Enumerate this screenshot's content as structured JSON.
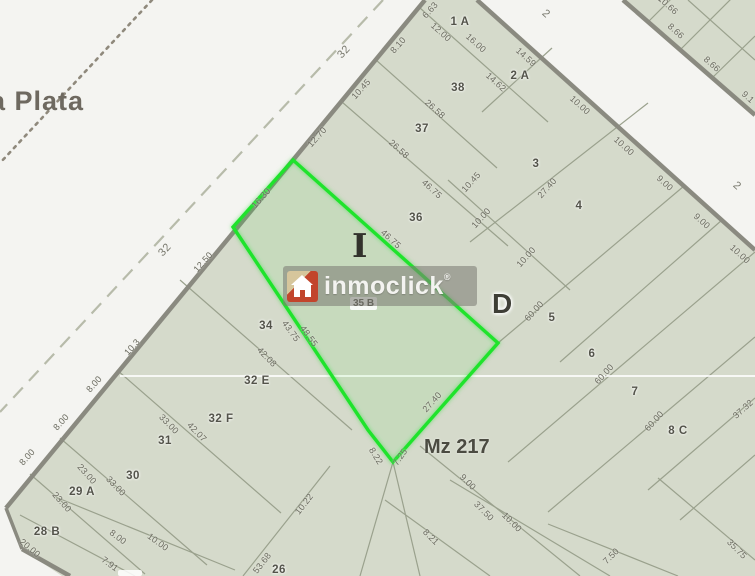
{
  "map": {
    "region_label": "a Plata",
    "block_label": "Mz 217",
    "area_letter_primary": "I",
    "area_letter_secondary": "D",
    "highlight_parcel_id": "35 B",
    "watermark": {
      "brand": "inmoclick",
      "registered_mark": "®",
      "icon": "house-icon"
    },
    "colors": {
      "highlight_green": "#1fe32c",
      "parcel_fill": "#d5dacb",
      "street_fill": "#f4f4f1",
      "street_edge": "#8a8a80",
      "lot_line": "#9aa18d",
      "watermark_red": "#c2452c",
      "watermark_tan": "#d6c69c"
    },
    "street_number_labels": [
      {
        "t": "32",
        "x": 344,
        "y": 52,
        "r": -48
      },
      {
        "t": "32",
        "x": 165,
        "y": 250,
        "r": -48
      },
      {
        "t": "2",
        "x": 546,
        "y": 14,
        "r": 42
      },
      {
        "t": "2",
        "x": 737,
        "y": 186,
        "r": 42
      }
    ],
    "parcel_labels": [
      {
        "t": "1 A",
        "x": 460,
        "y": 22
      },
      {
        "t": "2 A",
        "x": 520,
        "y": 76
      },
      {
        "t": "38",
        "x": 458,
        "y": 88
      },
      {
        "t": "37",
        "x": 422,
        "y": 129
      },
      {
        "t": "36",
        "x": 416,
        "y": 218
      },
      {
        "t": "3",
        "x": 536,
        "y": 164
      },
      {
        "t": "4",
        "x": 579,
        "y": 206
      },
      {
        "t": "5",
        "x": 552,
        "y": 318
      },
      {
        "t": "6",
        "x": 592,
        "y": 354
      },
      {
        "t": "7",
        "x": 635,
        "y": 392
      },
      {
        "t": "8 C",
        "x": 678,
        "y": 431
      },
      {
        "t": "34",
        "x": 266,
        "y": 326
      },
      {
        "t": "32 E",
        "x": 257,
        "y": 381
      },
      {
        "t": "32 F",
        "x": 221,
        "y": 419
      },
      {
        "t": "31",
        "x": 165,
        "y": 441
      },
      {
        "t": "30",
        "x": 133,
        "y": 476
      },
      {
        "t": "29 A",
        "x": 82,
        "y": 492
      },
      {
        "t": "28 B",
        "x": 47,
        "y": 532
      },
      {
        "t": "26",
        "x": 279,
        "y": 570
      }
    ],
    "measurement_labels": [
      {
        "t": "6.63",
        "x": 430,
        "y": 10,
        "r": -48
      },
      {
        "t": "8.10",
        "x": 398,
        "y": 45,
        "r": -48
      },
      {
        "t": "10.45",
        "x": 361,
        "y": 89,
        "r": -48
      },
      {
        "t": "12.70",
        "x": 317,
        "y": 137,
        "r": -48
      },
      {
        "t": "16.30",
        "x": 261,
        "y": 198,
        "r": -48
      },
      {
        "t": "12.50",
        "x": 203,
        "y": 262,
        "r": -48
      },
      {
        "t": "10.3",
        "x": 132,
        "y": 347,
        "r": -48
      },
      {
        "t": "8.00",
        "x": 94,
        "y": 384,
        "r": -48
      },
      {
        "t": "8.00",
        "x": 61,
        "y": 422,
        "r": -48
      },
      {
        "t": "8.00",
        "x": 27,
        "y": 457,
        "r": -48
      },
      {
        "t": "20.00",
        "x": 30,
        "y": 548,
        "r": 40
      },
      {
        "t": "7.91",
        "x": 110,
        "y": 564,
        "r": 36
      },
      {
        "t": "8.00",
        "x": 118,
        "y": 537,
        "r": 36
      },
      {
        "t": "10.00",
        "x": 158,
        "y": 542,
        "r": 36
      },
      {
        "t": "12.00",
        "x": 441,
        "y": 32,
        "r": 42
      },
      {
        "t": "16.00",
        "x": 476,
        "y": 43,
        "r": 42
      },
      {
        "t": "14.62",
        "x": 496,
        "y": 82,
        "r": 42
      },
      {
        "t": "26.58",
        "x": 435,
        "y": 109,
        "r": 42
      },
      {
        "t": "26.58",
        "x": 399,
        "y": 149,
        "r": 42
      },
      {
        "t": "46.75",
        "x": 432,
        "y": 189,
        "r": 42
      },
      {
        "t": "46.75",
        "x": 391,
        "y": 239,
        "r": 42
      },
      {
        "t": "43.75",
        "x": 291,
        "y": 331,
        "r": 54
      },
      {
        "t": "48.55",
        "x": 309,
        "y": 336,
        "r": 54
      },
      {
        "t": "42.08",
        "x": 267,
        "y": 357,
        "r": 46
      },
      {
        "t": "42.07",
        "x": 197,
        "y": 432,
        "r": 46
      },
      {
        "t": "33.00",
        "x": 169,
        "y": 424,
        "r": 46
      },
      {
        "t": "33.00",
        "x": 116,
        "y": 486,
        "r": 46
      },
      {
        "t": "23.00",
        "x": 87,
        "y": 474,
        "r": 48
      },
      {
        "t": "23.00",
        "x": 62,
        "y": 502,
        "r": 48
      },
      {
        "t": "14.59",
        "x": 526,
        "y": 57,
        "r": 42
      },
      {
        "t": "10.00",
        "x": 580,
        "y": 105,
        "r": 42
      },
      {
        "t": "10.00",
        "x": 624,
        "y": 146,
        "r": 42
      },
      {
        "t": "9.00",
        "x": 665,
        "y": 183,
        "r": 42
      },
      {
        "t": "9.00",
        "x": 702,
        "y": 221,
        "r": 42
      },
      {
        "t": "10.00",
        "x": 740,
        "y": 254,
        "r": 42
      },
      {
        "t": "10.66",
        "x": 668,
        "y": 5,
        "r": 42
      },
      {
        "t": "8.66",
        "x": 676,
        "y": 31,
        "r": 42
      },
      {
        "t": "8.66",
        "x": 712,
        "y": 64,
        "r": 42
      },
      {
        "t": "9.1",
        "x": 748,
        "y": 97,
        "r": 42
      },
      {
        "t": "10.45",
        "x": 471,
        "y": 182,
        "r": -48
      },
      {
        "t": "10.00",
        "x": 481,
        "y": 218,
        "r": -48
      },
      {
        "t": "10.00",
        "x": 526,
        "y": 257,
        "r": -48
      },
      {
        "t": "27.40",
        "x": 547,
        "y": 188,
        "r": -48
      },
      {
        "t": "60.00",
        "x": 534,
        "y": 311,
        "r": -48
      },
      {
        "t": "60.00",
        "x": 604,
        "y": 374,
        "r": -48
      },
      {
        "t": "60.00",
        "x": 654,
        "y": 421,
        "r": -48
      },
      {
        "t": "10.22",
        "x": 304,
        "y": 504,
        "r": -52
      },
      {
        "t": "53.68",
        "x": 262,
        "y": 563,
        "r": -52
      },
      {
        "t": "27.40",
        "x": 432,
        "y": 402,
        "r": -48
      },
      {
        "t": "7.25",
        "x": 400,
        "y": 457,
        "r": -55
      },
      {
        "t": "8.22",
        "x": 376,
        "y": 456,
        "r": 58
      },
      {
        "t": "37.32",
        "x": 743,
        "y": 409,
        "r": -42
      },
      {
        "t": "9.00",
        "x": 468,
        "y": 482,
        "r": 45
      },
      {
        "t": "37.50",
        "x": 484,
        "y": 511,
        "r": 45
      },
      {
        "t": "10.00",
        "x": 512,
        "y": 522,
        "r": 45
      },
      {
        "t": "8.21",
        "x": 431,
        "y": 537,
        "r": 45
      },
      {
        "t": "7.50",
        "x": 611,
        "y": 556,
        "r": -45
      },
      {
        "t": "35.75",
        "x": 737,
        "y": 549,
        "r": 45
      }
    ]
  }
}
